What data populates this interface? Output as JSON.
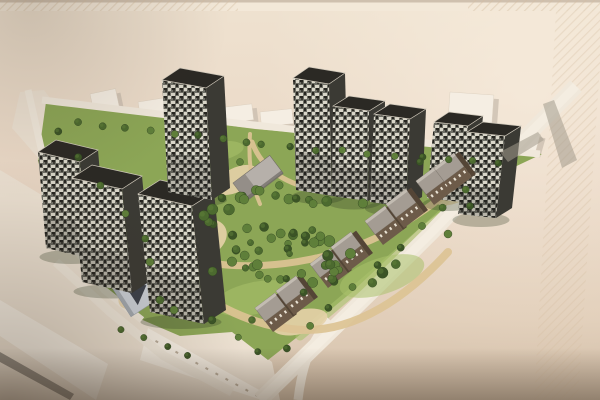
{
  "meta": {
    "description": "Photograph of an architectural masterplan rendering: aerial view of a residential development with nine dark speckled high-rise towers around a central tree-filled park, rows of brown low-rise townhouses along the south-east street, white existing context buildings at the edges, on a beige presentation board with diagonal hatched border bands."
  },
  "palette": {
    "board_top": "#efe2d0",
    "board_mid": "#e9d7c5",
    "board_low": "#e1ceb9",
    "board_bottom": "#d2bfa9",
    "top_strip": "#f3e8d8",
    "top_edge_line": "#a3907c",
    "hatch_line": "#d3bda0",
    "context_ground": "#ece2d3",
    "context_white": "#f5eee3",
    "context_shadow": "#c8bcad",
    "slab_dark_roof": "#837d75",
    "street": "#f0e8db",
    "street_light": "#f6f0e5",
    "grass": "#8ca656",
    "grass_light": "#a9c16c",
    "path_sand": "#dcc394",
    "path_sand_light": "#e6d2a8",
    "tree_dark": "#3b5426",
    "tree_mid": "#4c6a2f",
    "tree_light": "#5f7f3a",
    "tower_front_base": "#6f6f66",
    "tower_speck_light": "#d9d6c9",
    "tower_speck_dark": "#262520",
    "tower_side": "#3b3a34",
    "tower_roof": "#2b2924",
    "tower_roof_edge": "#cfc8ba",
    "townhouse_wall": "#6d5b49",
    "townhouse_wall_dark": "#544536",
    "townhouse_roof": "#a49c93",
    "townhouse_ridge": "#c3bcb2",
    "townhouse_window": "#e9e2d4",
    "school_roof": "#b6b0aa",
    "school_roof_dark": "#8c8680",
    "school_edge": "#6e6a64",
    "kg_body": "#ccd1d8",
    "kg_light": "#e7eaee",
    "kg_dark": "#3c414b",
    "kg_edge": "#9aa0a8",
    "shadow_streak": "#a39a8c",
    "tower_ground_shadow": "#2c381f",
    "vignette": "#3a2c1e",
    "photo_light": "#fff7ea"
  },
  "board": {
    "top_strip_h": 11,
    "hatch_left_w": 238,
    "hatch_right_x": 468,
    "right_band": "556,11 600,11 600,64 578,400 534,400"
  },
  "context": {
    "ground": "0,170 130,248 230,330 272,362 280,400 0,400",
    "street_wedge": "20,92 44,90 160,248 136,270 12,128",
    "blocks": [
      {
        "x": 56,
        "y": 112,
        "w": 30,
        "h": 20,
        "rot": -12
      },
      {
        "x": 90,
        "y": 94,
        "w": 26,
        "h": 18,
        "rot": -12
      },
      {
        "x": 138,
        "y": 102,
        "w": 28,
        "h": 17,
        "rot": -9
      },
      {
        "x": 218,
        "y": 108,
        "w": 34,
        "h": 16,
        "rot": -7
      },
      {
        "x": 260,
        "y": 112,
        "w": 32,
        "h": 15,
        "rot": -6
      },
      {
        "x": 320,
        "y": 107,
        "w": 38,
        "h": 15,
        "rot": -4
      },
      {
        "x": 368,
        "y": 106,
        "w": 26,
        "h": 13,
        "rot": -3
      },
      {
        "x": 450,
        "y": 92,
        "w": 44,
        "h": 32,
        "rot": 4
      },
      {
        "x": 504,
        "y": 124,
        "w": 38,
        "h": 20,
        "rot": 16
      }
    ],
    "slab_a": "0,300 108,364 96,400 0,336",
    "slab_a_dark": "0,352 74,394 70,400 0,362",
    "slab_b": "148,328 270,396 262,400 140,360",
    "slab_b_windows": {
      "from": [
        156,
        340
      ],
      "to": [
        256,
        394
      ],
      "count": 11
    },
    "block_c": {
      "x": 250,
      "y": 336,
      "w": 26,
      "h": 16,
      "rot": -37
    }
  },
  "site": {
    "green": "46,102 255,129 542,154 470,188 420,228 352,292 296,338 268,360 232,332 180,336 138,318 98,282 52,222 38,160",
    "verge": {
      "d": "M 468,190 C 430,226 372,276 300,336",
      "w": 9
    }
  },
  "roads": [
    {
      "d": "M 28,90 L 46,170 L 72,244 L 104,290 L 142,320",
      "w": 7,
      "main": false
    },
    {
      "d": "M 56,262 L 110,312 L 164,356 L 232,392",
      "w": 9,
      "main": false
    },
    {
      "d": "M 42,100 C 160,114 300,132 540,154",
      "w": 7,
      "main": false
    },
    {
      "d": "M 330,320 C 312,340 302,364 298,400",
      "w": 9,
      "main": false
    },
    {
      "d": "M 576,86 C 545,118 487,175 432,232 C 392,272 330,332 260,400",
      "w": 16,
      "main": true
    }
  ],
  "park": {
    "lawns": [
      {
        "cx": 255,
        "cy": 298,
        "rx": 42,
        "ry": 16,
        "rot": -12
      },
      {
        "cx": 382,
        "cy": 276,
        "rx": 44,
        "ry": 18,
        "rot": -18
      },
      {
        "cx": 214,
        "cy": 152,
        "rx": 30,
        "ry": 10,
        "rot": -10
      },
      {
        "cx": 480,
        "cy": 170,
        "rx": 26,
        "ry": 10,
        "rot": -20
      }
    ],
    "plazas": [
      {
        "cx": 198,
        "cy": 240,
        "rx": 30,
        "ry": 20,
        "rot": -22
      },
      {
        "cx": 456,
        "cy": 188,
        "rx": 26,
        "ry": 14,
        "rot": -28
      },
      {
        "cx": 300,
        "cy": 322,
        "rx": 28,
        "ry": 12,
        "rot": -14
      },
      {
        "cx": 140,
        "cy": 292,
        "rx": 24,
        "ry": 14,
        "rot": -32
      },
      {
        "cx": 236,
        "cy": 180,
        "rx": 24,
        "ry": 12,
        "rot": -26
      }
    ],
    "paths": [
      {
        "d": "M 158,256 C 196,300 252,328 304,330 C 356,331 406,298 448,252",
        "w": 8
      },
      {
        "d": "M 186,168 C 172,202 178,236 202,262",
        "w": 6
      },
      {
        "d": "M 252,142 C 262,170 288,186 322,190",
        "w": 5
      },
      {
        "d": "M 322,190 C 372,196 424,186 462,174",
        "w": 5
      },
      {
        "d": "M 202,262 C 262,272 332,262 392,230 C 424,212 448,194 464,176",
        "w": 7
      },
      {
        "d": "M 250,134 C 248,162 252,186 260,204",
        "w": 4
      },
      {
        "d": "M 158,256 C 150,230 158,200 186,168",
        "w": 6
      }
    ]
  },
  "towers": [
    {
      "x": 46,
      "y": 248,
      "w": 42,
      "h": 96,
      "lean": -8,
      "slope": 10,
      "dx": 18,
      "dy": -12
    },
    {
      "x": 82,
      "y": 282,
      "w": 50,
      "h": 104,
      "lean": -10,
      "slope": 11,
      "dx": 20,
      "dy": -13
    },
    {
      "x": 150,
      "y": 312,
      "w": 54,
      "h": 118,
      "lean": -12,
      "slope": 12,
      "dx": 22,
      "dy": -14
    },
    {
      "x": 168,
      "y": 192,
      "w": 44,
      "h": 112,
      "lean": -6,
      "slope": 8,
      "dx": 18,
      "dy": -12
    },
    {
      "x": 296,
      "y": 190,
      "w": 36,
      "h": 112,
      "lean": -3,
      "slope": 6,
      "dx": 16,
      "dy": -11
    },
    {
      "x": 332,
      "y": 196,
      "w": 36,
      "h": 90,
      "lean": 1,
      "slope": 5,
      "dx": 16,
      "dy": -10
    },
    {
      "x": 370,
      "y": 202,
      "w": 36,
      "h": 88,
      "lean": 4,
      "slope": 5,
      "dx": 16,
      "dy": -10
    },
    {
      "x": 427,
      "y": 198,
      "w": 34,
      "h": 76,
      "lean": 7,
      "slope": 4,
      "dx": 15,
      "dy": -10
    },
    {
      "x": 458,
      "y": 214,
      "w": 38,
      "h": 82,
      "lean": 9,
      "slope": 4,
      "dx": 16,
      "dy": -10
    }
  ],
  "townhouses": {
    "rot": -37,
    "blocks": [
      [
        273,
        332
      ],
      [
        294,
        315
      ],
      [
        328,
        288
      ],
      [
        349,
        271
      ],
      [
        383,
        245
      ],
      [
        404,
        228
      ],
      [
        434,
        205
      ],
      [
        452,
        192
      ]
    ]
  },
  "school": {
    "x": 258,
    "y": 178,
    "rot": -37,
    "w": 46,
    "h": 22
  },
  "kindergarten": {
    "x": 130,
    "y": 284,
    "rot": -33
  },
  "trees": {
    "clusters": [
      {
        "cx": 302,
        "cy": 240,
        "rx": 110,
        "ry": 56,
        "count": 46,
        "seed": 7,
        "rmin": 3.2,
        "rmax": 5.6
      },
      {
        "cx": 290,
        "cy": 255,
        "rx": 60,
        "ry": 32,
        "count": 18,
        "seed": 3,
        "rmin": 3.0,
        "rmax": 5.0
      }
    ],
    "rows": [
      {
        "from": [
          78,
          122
        ],
        "to": [
          248,
          142
        ],
        "count": 8,
        "r": 3.6,
        "jitter": 2,
        "seed": 11
      },
      {
        "from": [
          262,
          146
        ],
        "to": [
          500,
          164
        ],
        "count": 10,
        "r": 3.4,
        "jitter": 2,
        "seed": 12
      },
      {
        "from": [
          58,
          132
        ],
        "to": [
          146,
          240
        ],
        "count": 5,
        "r": 3.6,
        "jitter": 2,
        "seed": 13
      },
      {
        "from": [
          466,
          190
        ],
        "to": [
          286,
          346
        ],
        "count": 9,
        "r": 3.6,
        "jitter": 3,
        "seed": 14
      },
      {
        "from": [
          122,
          330
        ],
        "to": [
          188,
          356
        ],
        "count": 4,
        "r": 3.2,
        "jitter": 2,
        "seed": 15
      },
      {
        "from": [
          238,
          338
        ],
        "to": [
          258,
          352
        ],
        "count": 2,
        "r": 3.2,
        "jitter": 1,
        "seed": 16
      }
    ],
    "singles": [
      [
        222,
        198,
        4
      ],
      [
        240,
        162,
        3.5
      ],
      [
        160,
        300,
        4
      ],
      [
        174,
        310,
        4
      ],
      [
        420,
        162,
        3.5
      ],
      [
        448,
        234,
        4
      ],
      [
        470,
        206,
        3.5
      ],
      [
        212,
        320,
        4
      ],
      [
        252,
        320,
        3.5
      ],
      [
        150,
        262,
        4
      ]
    ]
  },
  "shadows": {
    "streaks": [
      "543,104 554,100 577,160 562,168",
      "500,152 538,132 544,140 508,162"
    ]
  },
  "photo": {
    "right_light": {
      "cx": 530,
      "cy": 90,
      "r": 270
    },
    "vignette_bl": {
      "cx": 10,
      "cy": 400,
      "r": 240
    },
    "vignette_tl": {
      "cx": 30,
      "cy": 0,
      "r": 200
    },
    "bottom_shade_y": 348
  }
}
